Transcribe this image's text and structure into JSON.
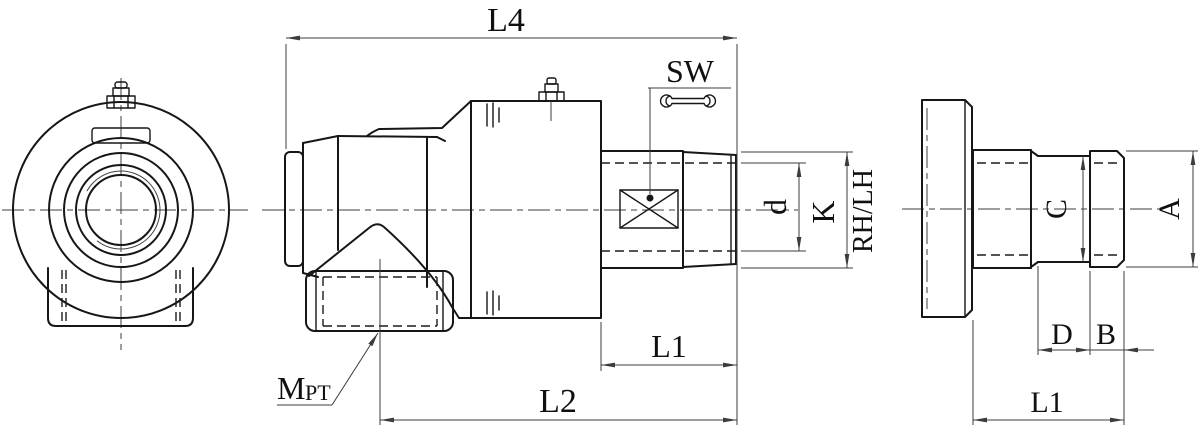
{
  "drawing": {
    "type": "engineering-3-view-drawing",
    "subject": "rotary-joint-swivel-fitting",
    "colors": {
      "background": "#ffffff",
      "outline": "#161616",
      "dimension_lines": "#3c3c3c",
      "text": "#101010"
    },
    "labels": {
      "l4": "L4",
      "sw": "SW",
      "d": "d",
      "k": "K",
      "rh_lh": "RH/LH",
      "l1_side": "L1",
      "l2": "L2",
      "m": "M",
      "pt": "PT",
      "c": "C",
      "a": "A",
      "d_end": "D",
      "b": "B",
      "l1_end": "L1"
    },
    "icons": {
      "wrench": "open-end-wrench",
      "grease_nipple": "grease-nipple",
      "hex_flats_marker": "crossed-box"
    }
  }
}
